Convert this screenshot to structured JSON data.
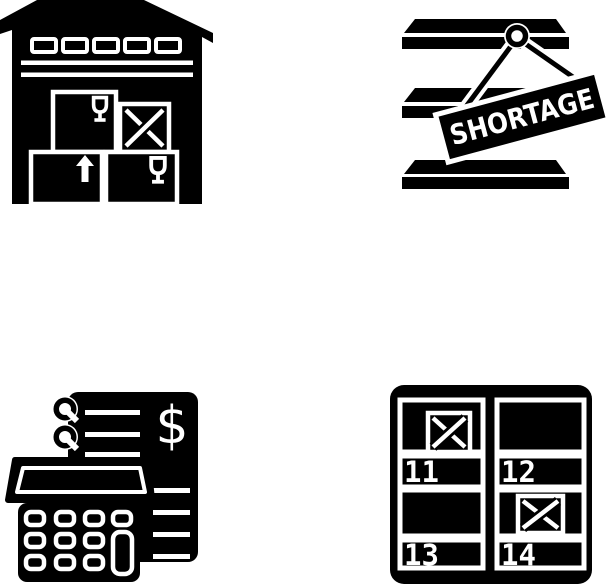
{
  "page": {
    "background_color": "#ffffff",
    "glyph_color": "#000000",
    "detail_color": "#ffffff"
  },
  "icons": [
    {
      "name": "warehouse-with-boxes"
    },
    {
      "name": "shortage-shelves",
      "sign_text": "SHORTAGE"
    },
    {
      "name": "expense-calculation",
      "currency_symbol": "$"
    },
    {
      "name": "numbered-storage-bins",
      "bin_numbers": [
        "11",
        "12",
        "13",
        "14"
      ]
    }
  ]
}
